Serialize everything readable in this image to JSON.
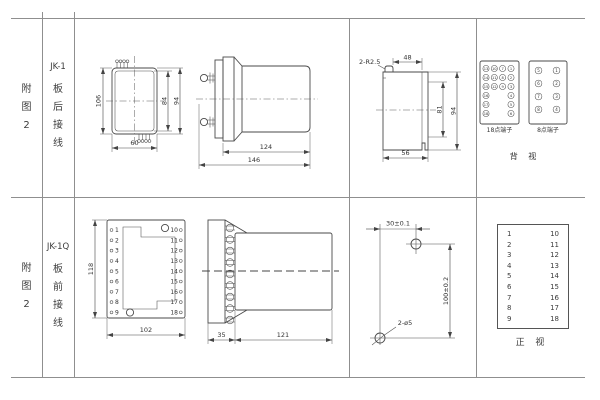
{
  "page": {
    "background": "#ffffff",
    "grid_line_color": "#8f8f8f",
    "ink_color": "#3c3c3c"
  },
  "row1": {
    "fig_label": "附\n图\n2",
    "model": "JK-1",
    "wiring_label": "板\n后\n接\n线",
    "front_view": {
      "dim_overall_h": "106",
      "dim_inner_h": "84",
      "dim_right_h": "94",
      "dim_w": "60"
    },
    "side_view": {
      "dim_body_len": "124",
      "dim_total_len": "146"
    },
    "rear_view": {
      "note_radius": "2-R2.5",
      "dim_top_w": "48",
      "dim_inner_h": "81",
      "dim_outer_h": "94",
      "dim_bottom_w": "56"
    },
    "terminals_18": {
      "label": "18点端子",
      "grid": [
        [
          "13",
          "10",
          "7",
          "1"
        ],
        [
          "14",
          "11",
          "8",
          "2"
        ],
        [
          "15",
          "12",
          "9",
          "3"
        ],
        [
          "16",
          "",
          "",
          "4"
        ],
        [
          "17",
          "",
          "",
          "5"
        ],
        [
          "18",
          "",
          "",
          "6"
        ]
      ]
    },
    "terminals_8": {
      "label": "8点端子",
      "grid": [
        [
          "5",
          "1"
        ],
        [
          "6",
          "2"
        ],
        [
          "7",
          "3"
        ],
        [
          "8",
          "4"
        ]
      ]
    },
    "view_label": "背 视"
  },
  "row2": {
    "fig_label": "附\n图\n2",
    "model": "JK-1Q",
    "wiring_label": "板\n前\n接\n线",
    "front_view": {
      "dim_h": "118",
      "dim_w": "102",
      "left_terminals": [
        "1",
        "2",
        "3",
        "4",
        "5",
        "6",
        "7",
        "8",
        "9"
      ],
      "right_terminals": [
        "10",
        "11",
        "12",
        "13",
        "14",
        "15",
        "16",
        "17",
        "18"
      ]
    },
    "side_view": {
      "dim_plate": "35",
      "dim_body_len": "121"
    },
    "drill_plan": {
      "dim_w": "30±0.1",
      "dim_h": "100±0.2",
      "note_holes": "2-ø5"
    },
    "terminal_table": {
      "left": [
        "1",
        "2",
        "3",
        "4",
        "5",
        "6",
        "7",
        "8",
        "9"
      ],
      "right": [
        "10",
        "11",
        "12",
        "13",
        "14",
        "15",
        "16",
        "17",
        "18"
      ]
    },
    "view_label": "正 视"
  }
}
